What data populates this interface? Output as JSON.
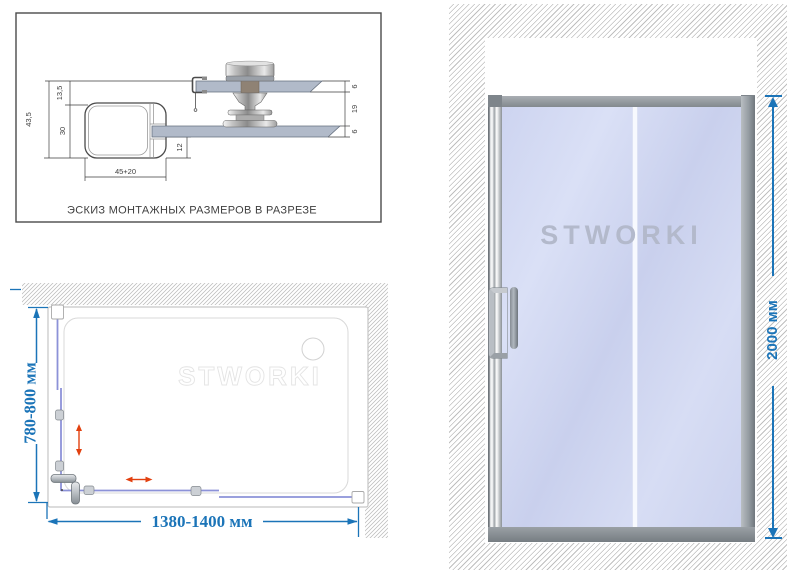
{
  "page": {
    "background": "#ffffff"
  },
  "colors": {
    "dimension_blue": "#1b74b8",
    "direction_arrow_red": "#e2400f",
    "glass_fill": "#ccd3ee",
    "frame_gray": "#8f969c",
    "sketch_line": "#3e3e3e",
    "plan_glass_line": "#8c92d8",
    "hatch_gray": "#b9b9b9"
  },
  "section_sketch": {
    "caption": "ЭСКИЗ МОНТАЖНЫХ РАЗМЕРОВ В РАЗРЕЗЕ",
    "dims": {
      "total_height": "43,5",
      "top_inset": "13,5",
      "profile_height": "30",
      "glass_to_bottom": "12",
      "profile_width": "45+20",
      "upper_glass_thickness": "6",
      "roller_gap": "19",
      "lower_glass_thickness": "6"
    }
  },
  "plan_view": {
    "depth_label": "780-800 мм",
    "width_label": "1380-1400 мм",
    "watermark": "STWORKI"
  },
  "front_view": {
    "logo": "STWORKI",
    "height_label": "2000 мм"
  }
}
